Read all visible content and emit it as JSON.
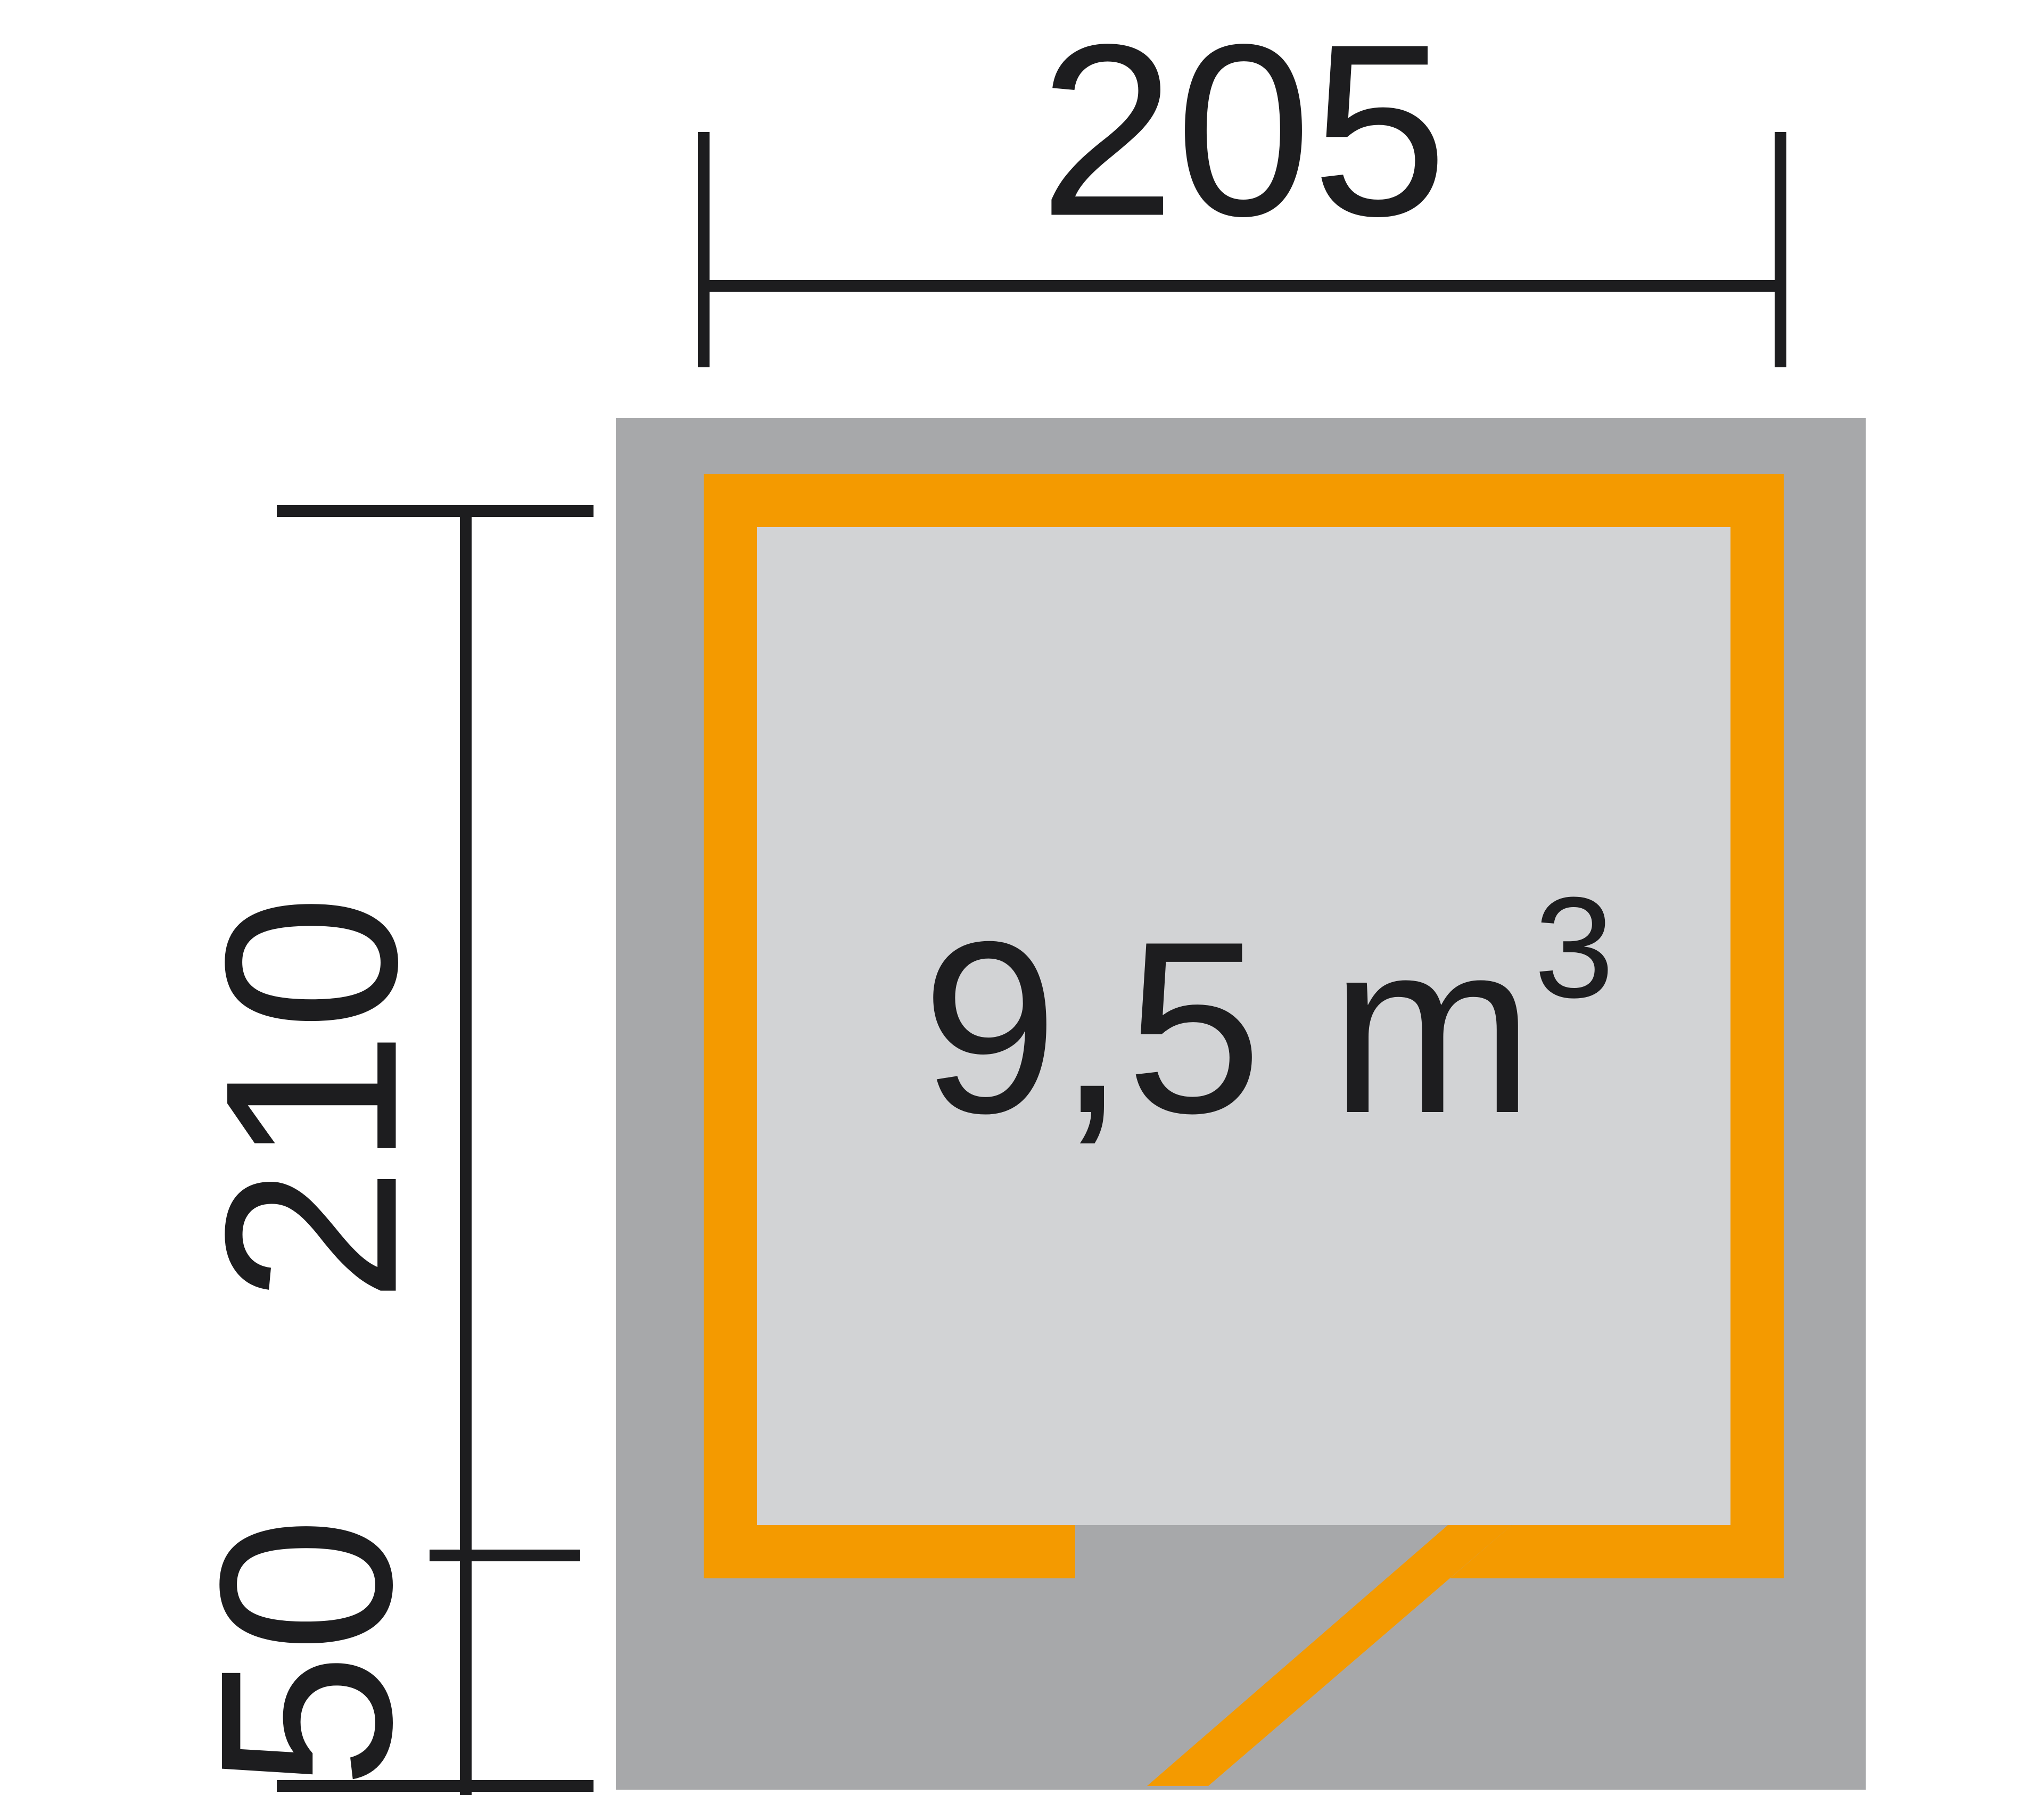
{
  "diagram": {
    "type": "shed-floor-plan",
    "width_dim": "205",
    "depth_dim": "210",
    "offset_dim": "50",
    "volume": {
      "main": "9,5 m",
      "sup": "3",
      "full": "9,5 m³"
    }
  },
  "colors": {
    "background": "#ffffff",
    "roof": "#a7a8aa",
    "interior": "#d2d3d5",
    "wall": "#f49a00",
    "line": "#1d1d1f"
  }
}
